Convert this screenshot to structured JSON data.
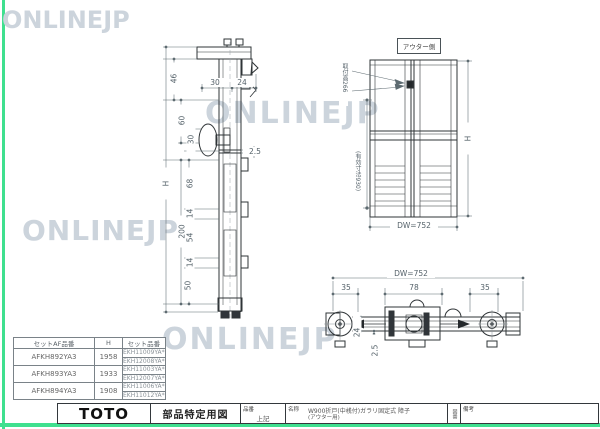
{
  "watermark": {
    "text": "ONLINEJP"
  },
  "side_section": {
    "d46": "46",
    "d30_top": "30",
    "d24_top": "24",
    "d60": "60",
    "d30": "30",
    "d2_5": "2.5",
    "dH": "H",
    "d68": "68",
    "d14_a": "14",
    "d200": "200",
    "d54": "54",
    "d14_b": "14",
    "d50": "50"
  },
  "elevation": {
    "view_label": "アウター側",
    "handle_note": "取付高266",
    "effective_note": "(有効寸法930)",
    "height_label": "H",
    "width_label": "DW=752"
  },
  "plan": {
    "width_label": "DW=752",
    "d35_left": "35",
    "d78": "78",
    "d35_right": "35",
    "d2_5": "2.5",
    "d24": "24"
  },
  "parts_table": {
    "headers": [
      "セットAF品番",
      "H",
      "セット品番"
    ],
    "rows": [
      {
        "af_no": "AFKH892YA3",
        "h": "1958",
        "set_no_1": "EKH11009YA*",
        "set_no_2": "EKH12008YA*"
      },
      {
        "af_no": "AFKH893YA3",
        "h": "1933",
        "set_no_1": "EKH11003YA*",
        "set_no_2": "EKH12007YA*"
      },
      {
        "af_no": "AFKH894YA3",
        "h": "1908",
        "set_no_1": "EKH11006YA*",
        "set_no_2": "EKH11012YA*"
      }
    ]
  },
  "title_block": {
    "logo": "TOTO",
    "doc_type": "部品特定用図",
    "part_no_label": "品番",
    "part_no_value": "上記",
    "name_label": "名称",
    "name_line1": "W900折戸(中桟付)ガラリ固定式 障子",
    "name_line2": "(アウター用)",
    "drawing_no_label": "図番",
    "remarks_label": "備考"
  },
  "colors": {
    "accent_green": "#3fe08f",
    "watermark": "#ccd4dc"
  }
}
